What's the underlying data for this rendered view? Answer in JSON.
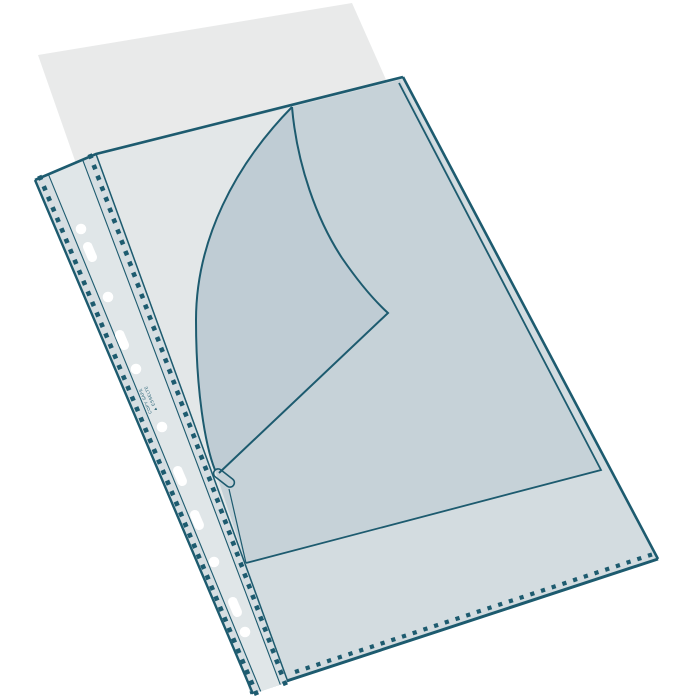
{
  "illustration": {
    "alt": "Transparent punched pocket (sheet protector) with an inserted paper sheet, front top corner folded back into a curl, multipunched reinforced spine",
    "spine_text": {
      "line1": "COPY SAFE",
      "line2": "▲ ESSELTE"
    },
    "colors": {
      "outline": "#1d5b6f",
      "background": "#ffffff",
      "paper": "#e9eaea",
      "pocket_film": "#d3dce0",
      "pocket_film_light": "#e3e7e8",
      "inner_sheet": "#c6d2d8",
      "flap": "#bfccd4",
      "spine_strip": "#d6dee2",
      "hole_strip": "#e0e6e8",
      "hole_fill": "#ffffff"
    }
  }
}
